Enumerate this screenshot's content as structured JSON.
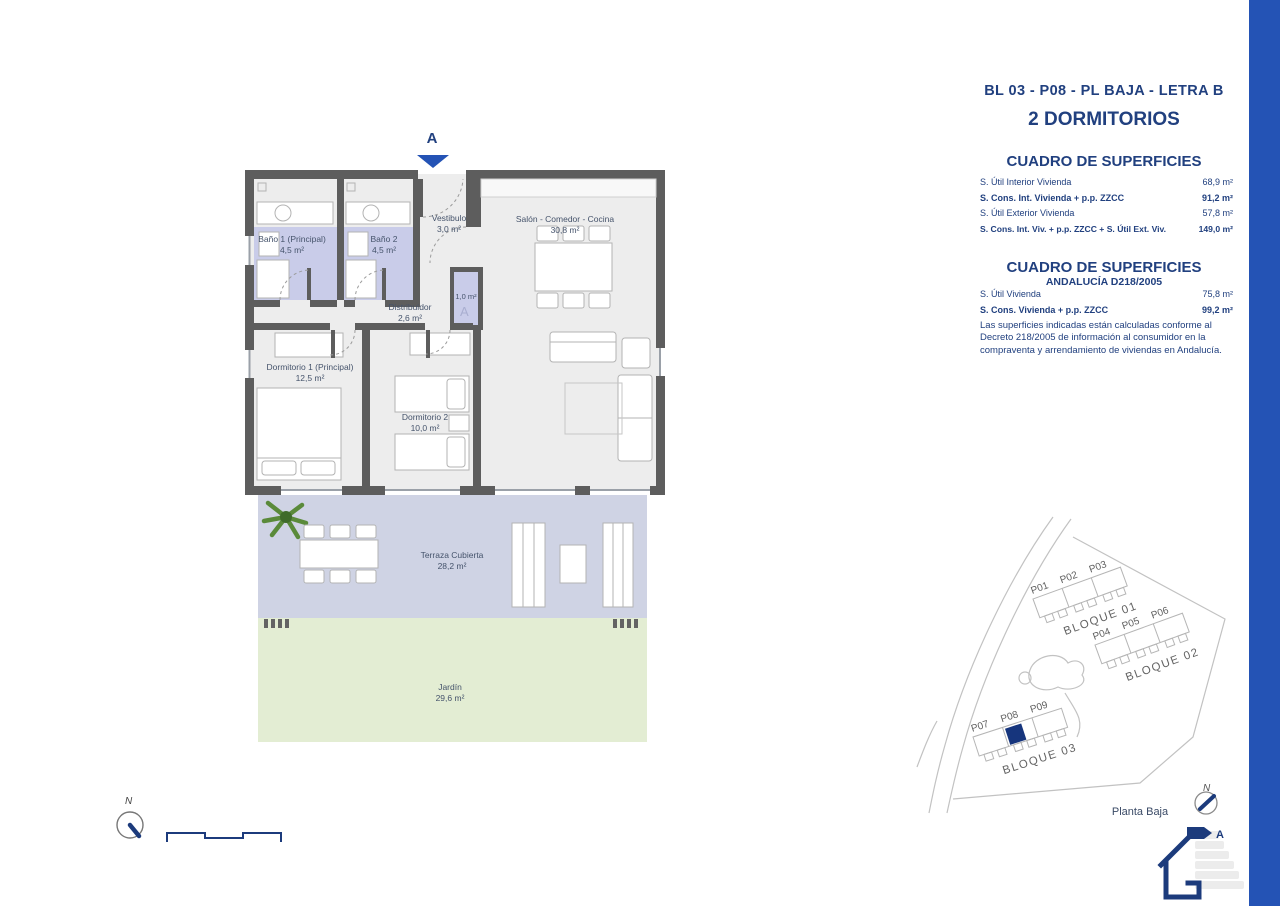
{
  "colors": {
    "accent_navy": "#21407f",
    "sidebar_blue": "#2453b5",
    "wall_gray": "#5d5d5d",
    "bath_lavender": "#c9cce9",
    "terrace_lavender": "#cfd3e4",
    "garden_green": "#e3edd3",
    "highlight_unit_navy": "#16357d"
  },
  "header": {
    "title": "BL 03 - P08 - PL BAJA - LETRA B",
    "subtitle": "2 DORMITORIOS"
  },
  "tables": [
    {
      "heading": "CUADRO DE SUPERFICIES",
      "rows": [
        {
          "label": "S. Útil Interior Vivienda",
          "value": "68,9 m²"
        },
        {
          "label": "S. Cons. Int. Vivienda + p.p. ZZCC",
          "value": "91,2 m²"
        },
        {
          "label": "S. Útil Exterior Vivienda",
          "value": "57,8 m²"
        },
        {
          "label": "S. Cons. Int. Viv. + p.p. ZZCC + S. Útil Ext. Viv.",
          "value": "149,0 m²"
        }
      ]
    },
    {
      "heading": "CUADRO DE SUPERFICIES",
      "subheading": "ANDALUCÍA D218/2005",
      "rows": [
        {
          "label": "S. Útil Vivienda",
          "value": "75,8 m²"
        },
        {
          "label": "S. Cons. Vivienda + p.p. ZZCC",
          "value": "99,2 m²"
        }
      ],
      "note": "Las superficies indicadas están calculadas conforme al Decreto 218/2005 de información al consumidor en la compraventa y arrendamiento de viviendas en Andalucía."
    }
  ],
  "floor_plan": {
    "section_marker": "A",
    "closet_area": "1,0 m²",
    "rooms": [
      {
        "name": "Baño 1 (Principal)",
        "area": "4,5 m²"
      },
      {
        "name": "Baño 2",
        "area": "4,5 m²"
      },
      {
        "name": "Vestibulo",
        "area": "3,0 m²"
      },
      {
        "name": "Salón - Comedor - Cocina",
        "area": "30,8 m²"
      },
      {
        "name": "Distribuidor",
        "area": "2,6 m²"
      },
      {
        "name": "Dormitorio 1 (Principal)",
        "area": "12,5 m²"
      },
      {
        "name": "Dormitorio 2",
        "area": "10,0 m²"
      }
    ]
  },
  "terrace": {
    "name": "Terraza Cubierta",
    "area": "28,2 m²"
  },
  "garden": {
    "name": "Jardín",
    "area": "29,6 m²"
  },
  "site_plan": {
    "caption": "Planta Baja",
    "compass": "N",
    "blocks": [
      "BLOQUE 01",
      "BLOQUE 02",
      "BLOQUE 03"
    ],
    "units": [
      "P01",
      "P02",
      "P03",
      "P04",
      "P05",
      "P06",
      "P07",
      "P08",
      "P09"
    ]
  },
  "compass": {
    "label": "N"
  },
  "energy": {
    "rating": "A"
  }
}
